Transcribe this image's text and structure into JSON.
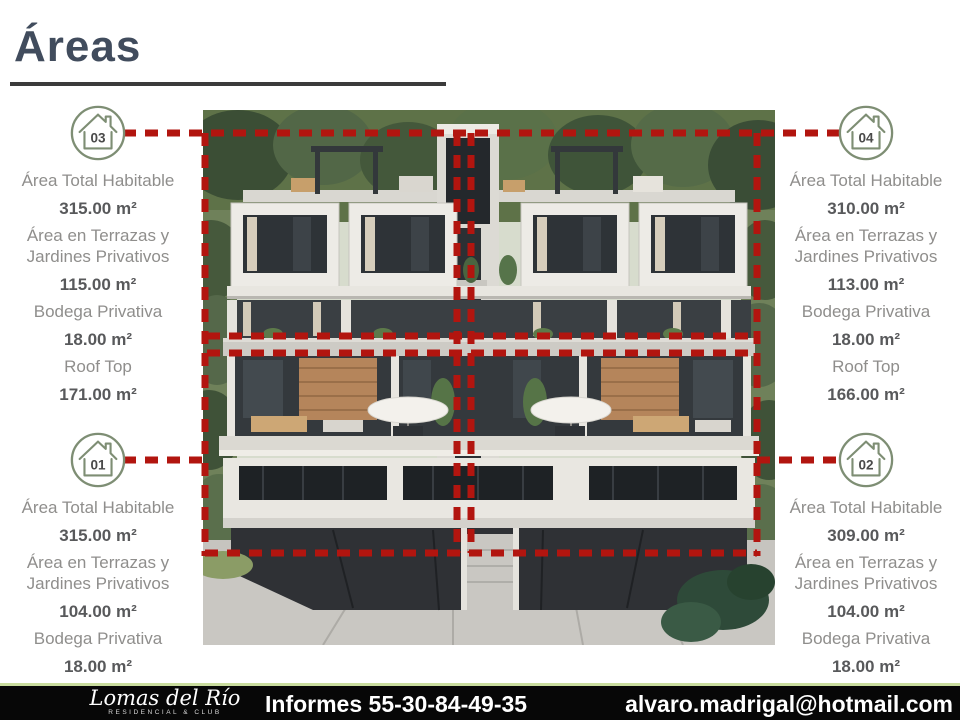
{
  "title": {
    "text": "Áreas"
  },
  "units": [
    {
      "number": "03",
      "position": "top-left",
      "rows": [
        {
          "label": "Área Total  Habitable",
          "value": "315.00 m²"
        },
        {
          "label": "Área en Terrazas y Jardines Privativos",
          "value": "115.00 m²"
        },
        {
          "label": "Bodega Privativa",
          "value": "18.00 m²"
        },
        {
          "label": "Roof Top",
          "value": "171.00 m²"
        }
      ]
    },
    {
      "number": "04",
      "position": "top-right",
      "rows": [
        {
          "label": "Área Total  Habitable",
          "value": "310.00 m²"
        },
        {
          "label": "Área en Terrazas y Jardines Privativos",
          "value": "113.00 m²"
        },
        {
          "label": "Bodega Privativa",
          "value": "18.00 m²"
        },
        {
          "label": "Roof Top",
          "value": "166.00 m²"
        }
      ]
    },
    {
      "number": "01",
      "position": "bottom-left",
      "rows": [
        {
          "label": "Área Total  Habitable",
          "value": "315.00 m²"
        },
        {
          "label": "Área en Terrazas y Jardines Privativos",
          "value": "104.00 m²"
        },
        {
          "label": "Bodega Privativa",
          "value": "18.00 m²"
        }
      ]
    },
    {
      "number": "02",
      "position": "bottom-right",
      "rows": [
        {
          "label": "Área Total  Habitable",
          "value": "309.00 m²"
        },
        {
          "label": "Área en Terrazas y Jardines Privativos",
          "value": "104.00 m²"
        },
        {
          "label": "Bodega Privativa",
          "value": "18.00 m²"
        }
      ]
    }
  ],
  "footer": {
    "brand": "Lomas del Río",
    "brand_subtitle": "RESIDENCIAL & CLUB",
    "contact_label": "Informes 55-30-84-49-35",
    "email": "alvaro.madrigal@hotmail.com"
  },
  "colors": {
    "accent_red": "#b2150f",
    "icon_green": "#7e8e74",
    "label_gray": "#8f8e8c",
    "value_gray": "#58595b",
    "title_color": "#414c5d",
    "footer_border_green": "#c9dc9e"
  }
}
